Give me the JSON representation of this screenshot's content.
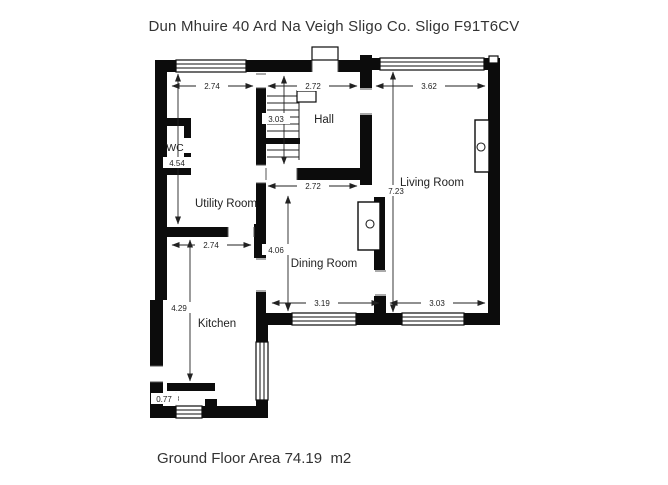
{
  "title": "Dun Mhuire 40 Ard Na Veigh Sligo Co. Sligo F91T6CV",
  "footer": "Ground Floor Area 74.19  m2",
  "rooms": {
    "wc": "WC",
    "hall": "Hall",
    "utility": "Utility Room",
    "living": "Living Room",
    "dining": "Dining Room",
    "kitchen": "Kitchen"
  },
  "dims": {
    "utility_top": "2.74",
    "hall_top": "2.72",
    "living_top": "3.62",
    "hall_stairs": "3.03",
    "wc_column": "4.54",
    "living_height": "7.23",
    "dining_top": "2.72",
    "dining_height": "4.06",
    "kitchen_top": "2.74",
    "kitchen_height": "4.29",
    "kitchen_lobby": "0.77",
    "dining_bottom": "3.19",
    "living_bottom": "3.03"
  },
  "colors": {
    "wall": "#0c0c0c",
    "text": "#333333"
  }
}
